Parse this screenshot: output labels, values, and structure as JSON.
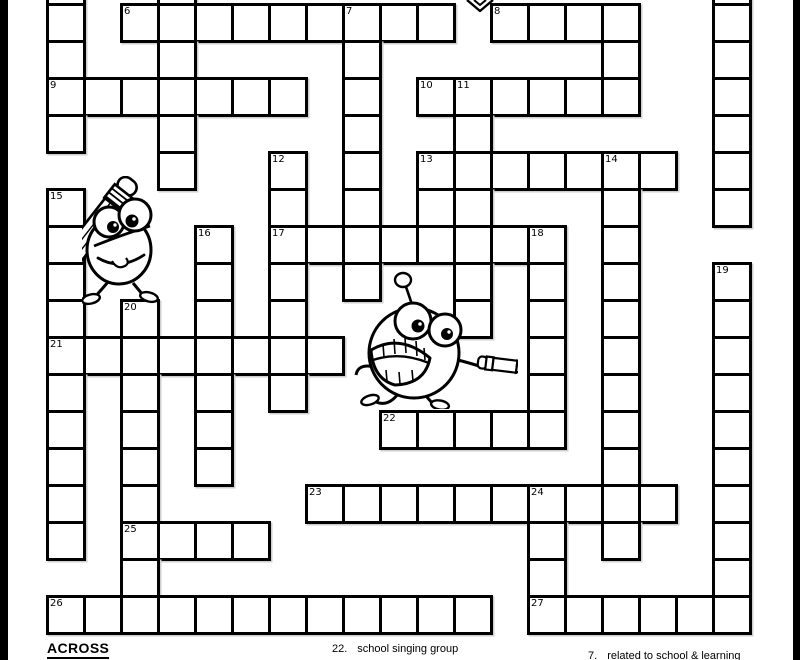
{
  "colors": {
    "page_bg": "#ffffff",
    "edge_bar": "#000000",
    "grid_line": "#000000",
    "cell_fill": "#ffffff",
    "text": "#000000"
  },
  "grid": {
    "cols": 19,
    "cell_px": 37,
    "origin_x": 46,
    "origin_y": 3,
    "rows": [
      {
        "r": -1,
        "cols": [
          0,
          3,
          18
        ]
      },
      {
        "r": 0,
        "cols": [
          0,
          2,
          3,
          4,
          5,
          6,
          7,
          8,
          9,
          10,
          12,
          13,
          14,
          15,
          18
        ]
      },
      {
        "r": 1,
        "cols": [
          0,
          3,
          8,
          15,
          18
        ]
      },
      {
        "r": 2,
        "cols": [
          0,
          1,
          2,
          3,
          4,
          5,
          6,
          8,
          10,
          11,
          12,
          13,
          14,
          15,
          18
        ]
      },
      {
        "r": 3,
        "cols": [
          0,
          3,
          8,
          11,
          18
        ]
      },
      {
        "r": 4,
        "cols": [
          3,
          6,
          8,
          10,
          11,
          12,
          13,
          14,
          15,
          16,
          18
        ]
      },
      {
        "r": 5,
        "cols": [
          0,
          6,
          8,
          10,
          11,
          15,
          18
        ]
      },
      {
        "r": 6,
        "cols": [
          0,
          4,
          6,
          7,
          8,
          9,
          10,
          11,
          12,
          13,
          15
        ]
      },
      {
        "r": 7,
        "cols": [
          0,
          4,
          6,
          8,
          11,
          13,
          15,
          18
        ]
      },
      {
        "r": 8,
        "cols": [
          0,
          2,
          4,
          6,
          11,
          13,
          15,
          18
        ]
      },
      {
        "r": 9,
        "cols": [
          0,
          1,
          2,
          3,
          4,
          5,
          6,
          7,
          13,
          15,
          18
        ]
      },
      {
        "r": 10,
        "cols": [
          0,
          2,
          4,
          6,
          13,
          15,
          18
        ]
      },
      {
        "r": 11,
        "cols": [
          0,
          2,
          4,
          9,
          10,
          11,
          12,
          13,
          15,
          18
        ]
      },
      {
        "r": 12,
        "cols": [
          0,
          2,
          4,
          15,
          18
        ]
      },
      {
        "r": 13,
        "cols": [
          0,
          2,
          7,
          8,
          9,
          10,
          11,
          12,
          13,
          14,
          15,
          16,
          18
        ]
      },
      {
        "r": 14,
        "cols": [
          0,
          2,
          3,
          4,
          5,
          13,
          15,
          18
        ]
      },
      {
        "r": 15,
        "cols": [
          2,
          13,
          18
        ]
      },
      {
        "r": 16,
        "cols": [
          0,
          1,
          2,
          3,
          4,
          5,
          6,
          7,
          8,
          9,
          10,
          11,
          13,
          14,
          15,
          16,
          17,
          18
        ]
      }
    ],
    "numbers": [
      {
        "n": "6",
        "r": 0,
        "c": 2
      },
      {
        "n": "7",
        "r": 0,
        "c": 8
      },
      {
        "n": "8",
        "r": 0,
        "c": 12
      },
      {
        "n": "9",
        "r": 2,
        "c": 0
      },
      {
        "n": "10",
        "r": 2,
        "c": 10
      },
      {
        "n": "11",
        "r": 2,
        "c": 11
      },
      {
        "n": "12",
        "r": 4,
        "c": 6
      },
      {
        "n": "13",
        "r": 4,
        "c": 10
      },
      {
        "n": "14",
        "r": 4,
        "c": 15
      },
      {
        "n": "15",
        "r": 5,
        "c": 0
      },
      {
        "n": "16",
        "r": 6,
        "c": 4
      },
      {
        "n": "17",
        "r": 6,
        "c": 6
      },
      {
        "n": "18",
        "r": 6,
        "c": 13
      },
      {
        "n": "19",
        "r": 7,
        "c": 18
      },
      {
        "n": "20",
        "r": 8,
        "c": 2
      },
      {
        "n": "21",
        "r": 9,
        "c": 0
      },
      {
        "n": "22",
        "r": 11,
        "c": 9
      },
      {
        "n": "23",
        "r": 13,
        "c": 7
      },
      {
        "n": "24",
        "r": 13,
        "c": 13
      },
      {
        "n": "25",
        "r": 14,
        "c": 2
      },
      {
        "n": "26",
        "r": 16,
        "c": 0
      },
      {
        "n": "27",
        "r": 16,
        "c": 13
      }
    ]
  },
  "clues": {
    "across_heading": "ACROSS",
    "visible_clues": [
      {
        "number": "22.",
        "text": "school singing group"
      },
      {
        "number": "7.",
        "text": "related to school & learning"
      }
    ]
  },
  "decorations": {
    "icons": [
      "pencil-mascot-icon",
      "running-mascot-icon",
      "chevron-down-icon"
    ]
  }
}
